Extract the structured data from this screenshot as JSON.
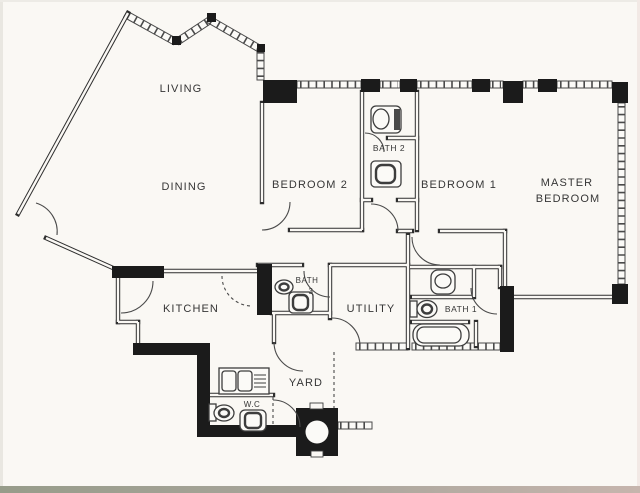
{
  "page": {
    "paper_color": "#faf8f4",
    "wall_color": "#2e2e2e",
    "solid_wall_color": "#1b1b1b",
    "bottom_strip_colors": [
      "#979c8a",
      "#a9a59b",
      "#c6b5ad"
    ]
  },
  "floor_plan": {
    "rooms": {
      "living": {
        "label": "LIVING"
      },
      "dining": {
        "label": "DINING"
      },
      "bedroom2": {
        "label": "BEDROOM 2"
      },
      "bedroom1": {
        "label": "BEDROOM 1"
      },
      "master_bedroom": {
        "label_line1": "MASTER",
        "label_line2": "BEDROOM"
      },
      "bath2": {
        "label": "BATH 2"
      },
      "bath3": {
        "label_line1": "BATH",
        "label_line2": "3"
      },
      "bath1": {
        "label": "BATH 1"
      },
      "kitchen": {
        "label": "KITCHEN"
      },
      "utility": {
        "label": "UTILITY"
      },
      "yard": {
        "label": "YARD"
      },
      "wc": {
        "label": "W.C"
      }
    },
    "fixtures": [
      "toilet",
      "sink",
      "bathtub",
      "washing-machine",
      "service-duct-column"
    ]
  }
}
